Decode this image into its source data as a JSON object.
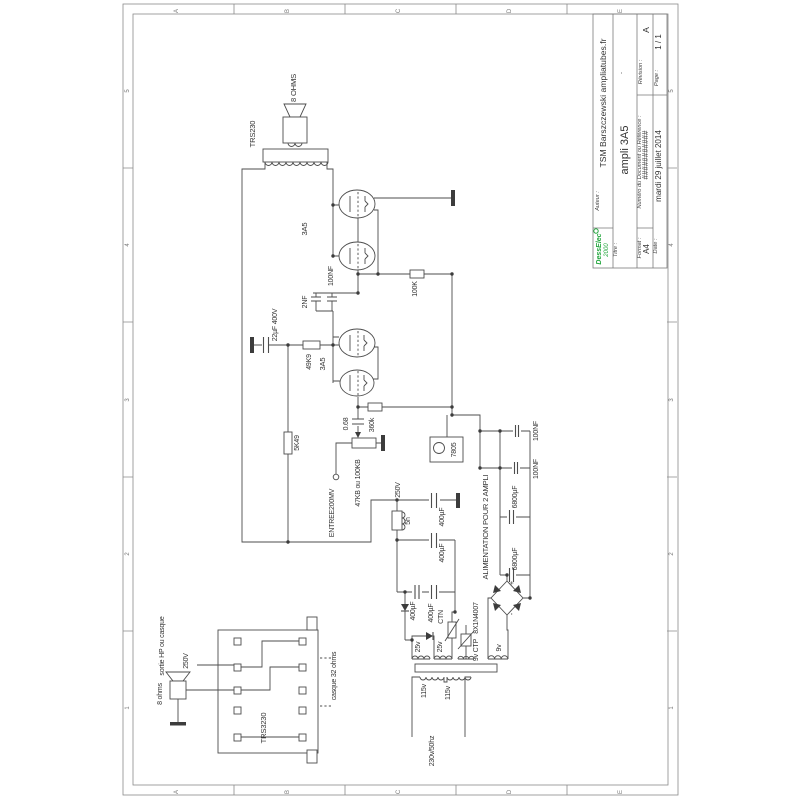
{
  "frame": {
    "cols": [
      "A",
      "B",
      "C",
      "D",
      "E"
    ],
    "rows": [
      "5",
      "4",
      "3",
      "2",
      "1"
    ]
  },
  "title_block": {
    "logo_line1": "DessElec",
    "logo_line2": "2000",
    "auteur_label": "Auteur :",
    "auteur": "TSM Barszczewski  ampliatubes.fr",
    "titre_label": "Titre :",
    "titre": "ampli 3A5",
    "titre_note": ".",
    "numero_label": "Numéro du Document ou Référence :",
    "numero": "###########",
    "revision_label": "Révision :",
    "revision": "A",
    "format_label": "Format :",
    "format": "A4",
    "date_label": "Date :",
    "date": "mardi 29 juillet 2014",
    "page_label": "Page :",
    "page": "1 / 1"
  },
  "schematic": {
    "output_transformer": "TRS230",
    "speaker_top": "8 OHMS",
    "tube": "3A5",
    "cap_100nf": "100NF",
    "cap_2nf": "2NF",
    "r_100k": "100K",
    "cap_22uf": "22µF 400V",
    "r_49k9": "49K9",
    "cap_068": "0.68",
    "r_360k": "360k",
    "pot": "47KB ou 100KB",
    "input": "ENTREE200MV",
    "regulator": "7805",
    "alim": "ALIMENTATION POUR 2 AMPLI",
    "cap_6800uf": "6800µF",
    "cap_400uf": "400µF",
    "hv": "250V",
    "choke": "5h",
    "ctn": "CTN",
    "diodes": "8X1N4007",
    "w25v": "25v",
    "w9vctp": "9v CTP",
    "w9v": "9v",
    "w115v": "115v",
    "mains": "230v/50hz",
    "plus": "+",
    "minus": "-",
    "jack_block": "TRS3230",
    "sortie": "sortie HP ou casque",
    "hv_left": "250V",
    "speaker_left": "8 ohms",
    "casque": "casque 32 ohms"
  }
}
